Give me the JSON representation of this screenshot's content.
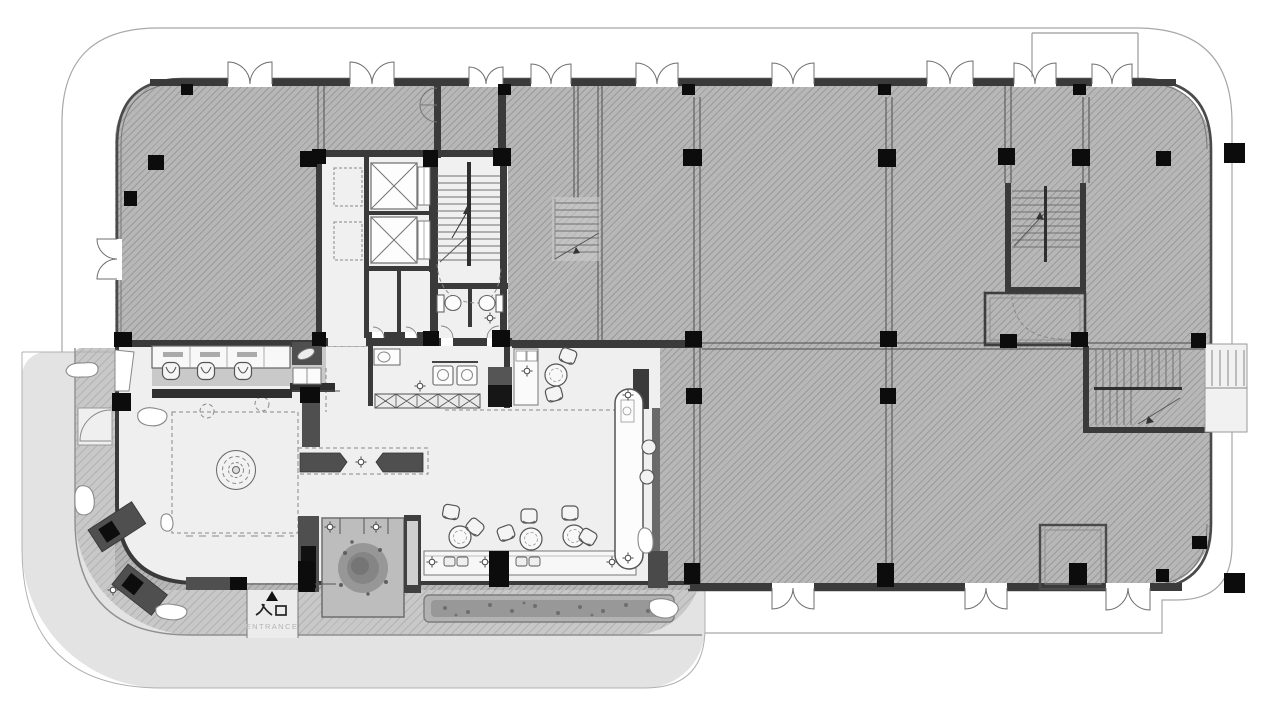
{
  "labels": {
    "entrance_cn": "入口",
    "entrance_en": "ENTRANCE"
  },
  "colors": {
    "site_outline": "#a8a8a8",
    "plaza": "#e3e3e3",
    "terrace": "#c8c8c8",
    "slab": "#b7b7b7",
    "interior_floor": "#efefef",
    "wall": "#3a3a3a",
    "column": "#0c0c0c",
    "furniture_dark": "#4f4f4f",
    "entrance_text": "#222222",
    "entrance_subtext": "#b5b5b5"
  }
}
